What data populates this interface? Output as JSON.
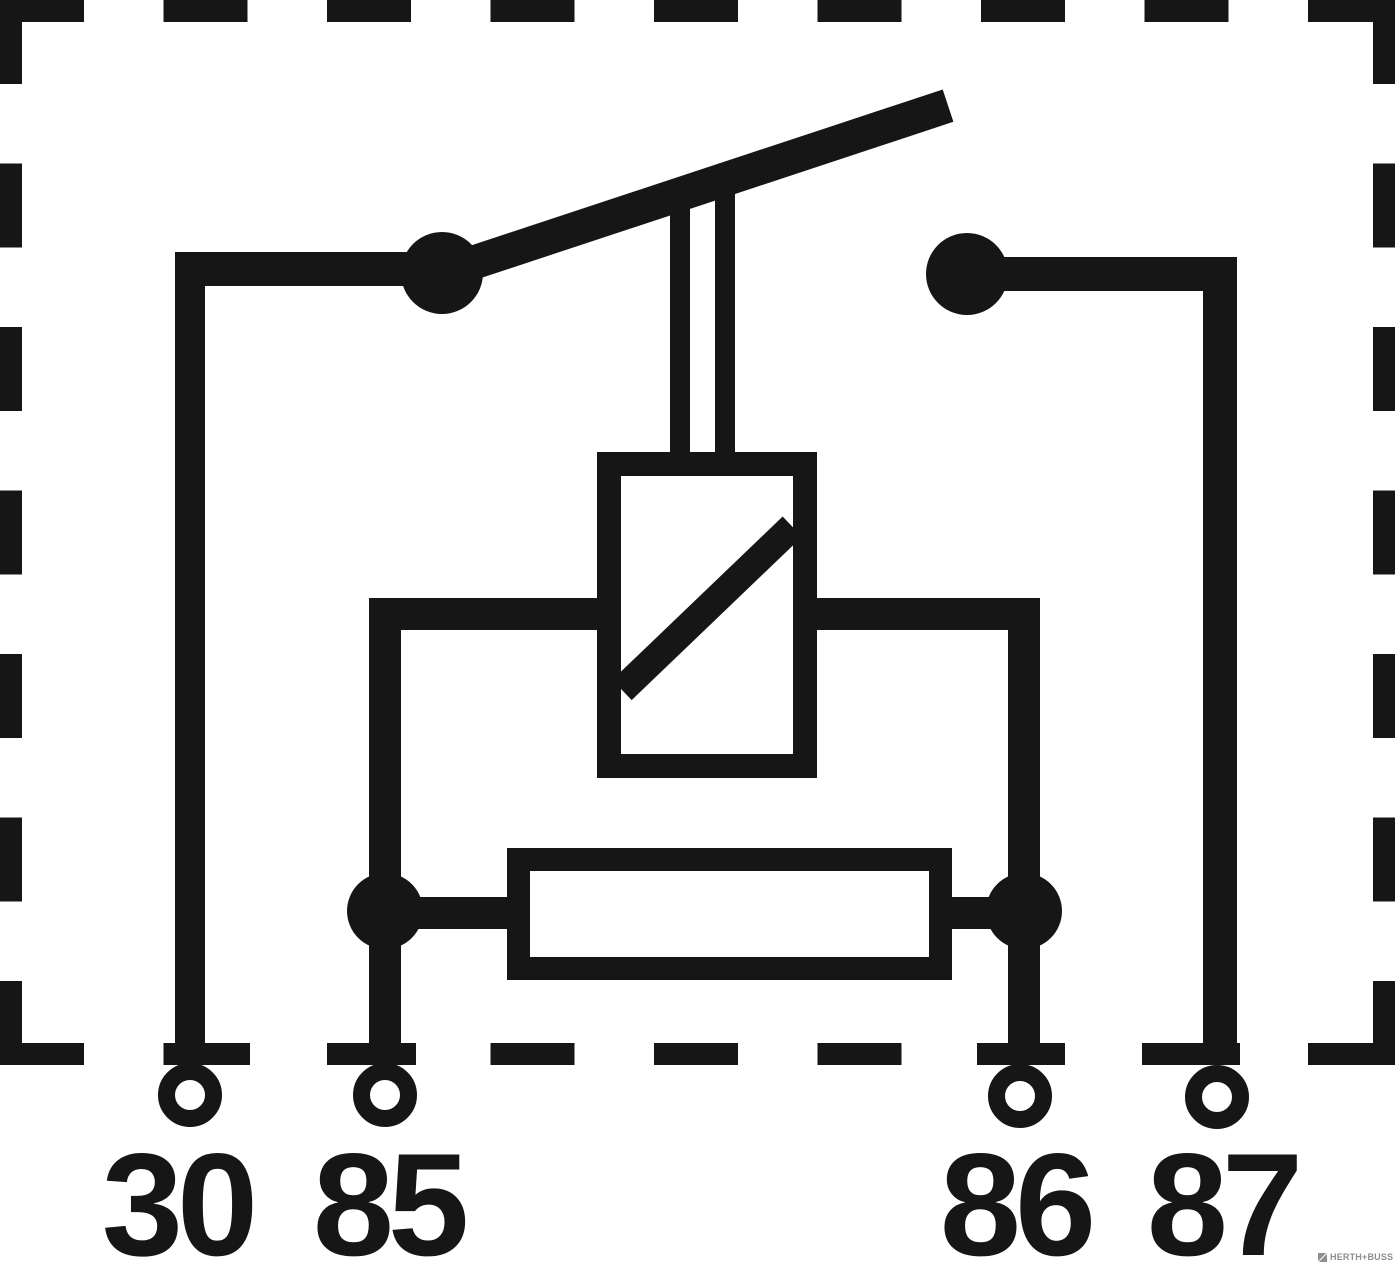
{
  "diagram": {
    "type": "relay-circuit-schematic",
    "terminals": [
      {
        "id": "30",
        "label": "30"
      },
      {
        "id": "85",
        "label": "85"
      },
      {
        "id": "86",
        "label": "86"
      },
      {
        "id": "87",
        "label": "87"
      }
    ],
    "shapes": {
      "switch_arm": "diagonal-contact-lever",
      "actuator": "double-line-mechanical-link",
      "coil": "rectangle-with-diagonal",
      "resistor": "horizontal-rectangle",
      "junction_dot": "filled-circle",
      "terminal_ring": "open-circle",
      "boundary": "dashed-rectangle"
    },
    "colors": {
      "ink": "#161616",
      "background": "#ffffff",
      "logo_gray": "#8e8e8e"
    },
    "logo": {
      "text": "HERTH+BUSS"
    }
  }
}
